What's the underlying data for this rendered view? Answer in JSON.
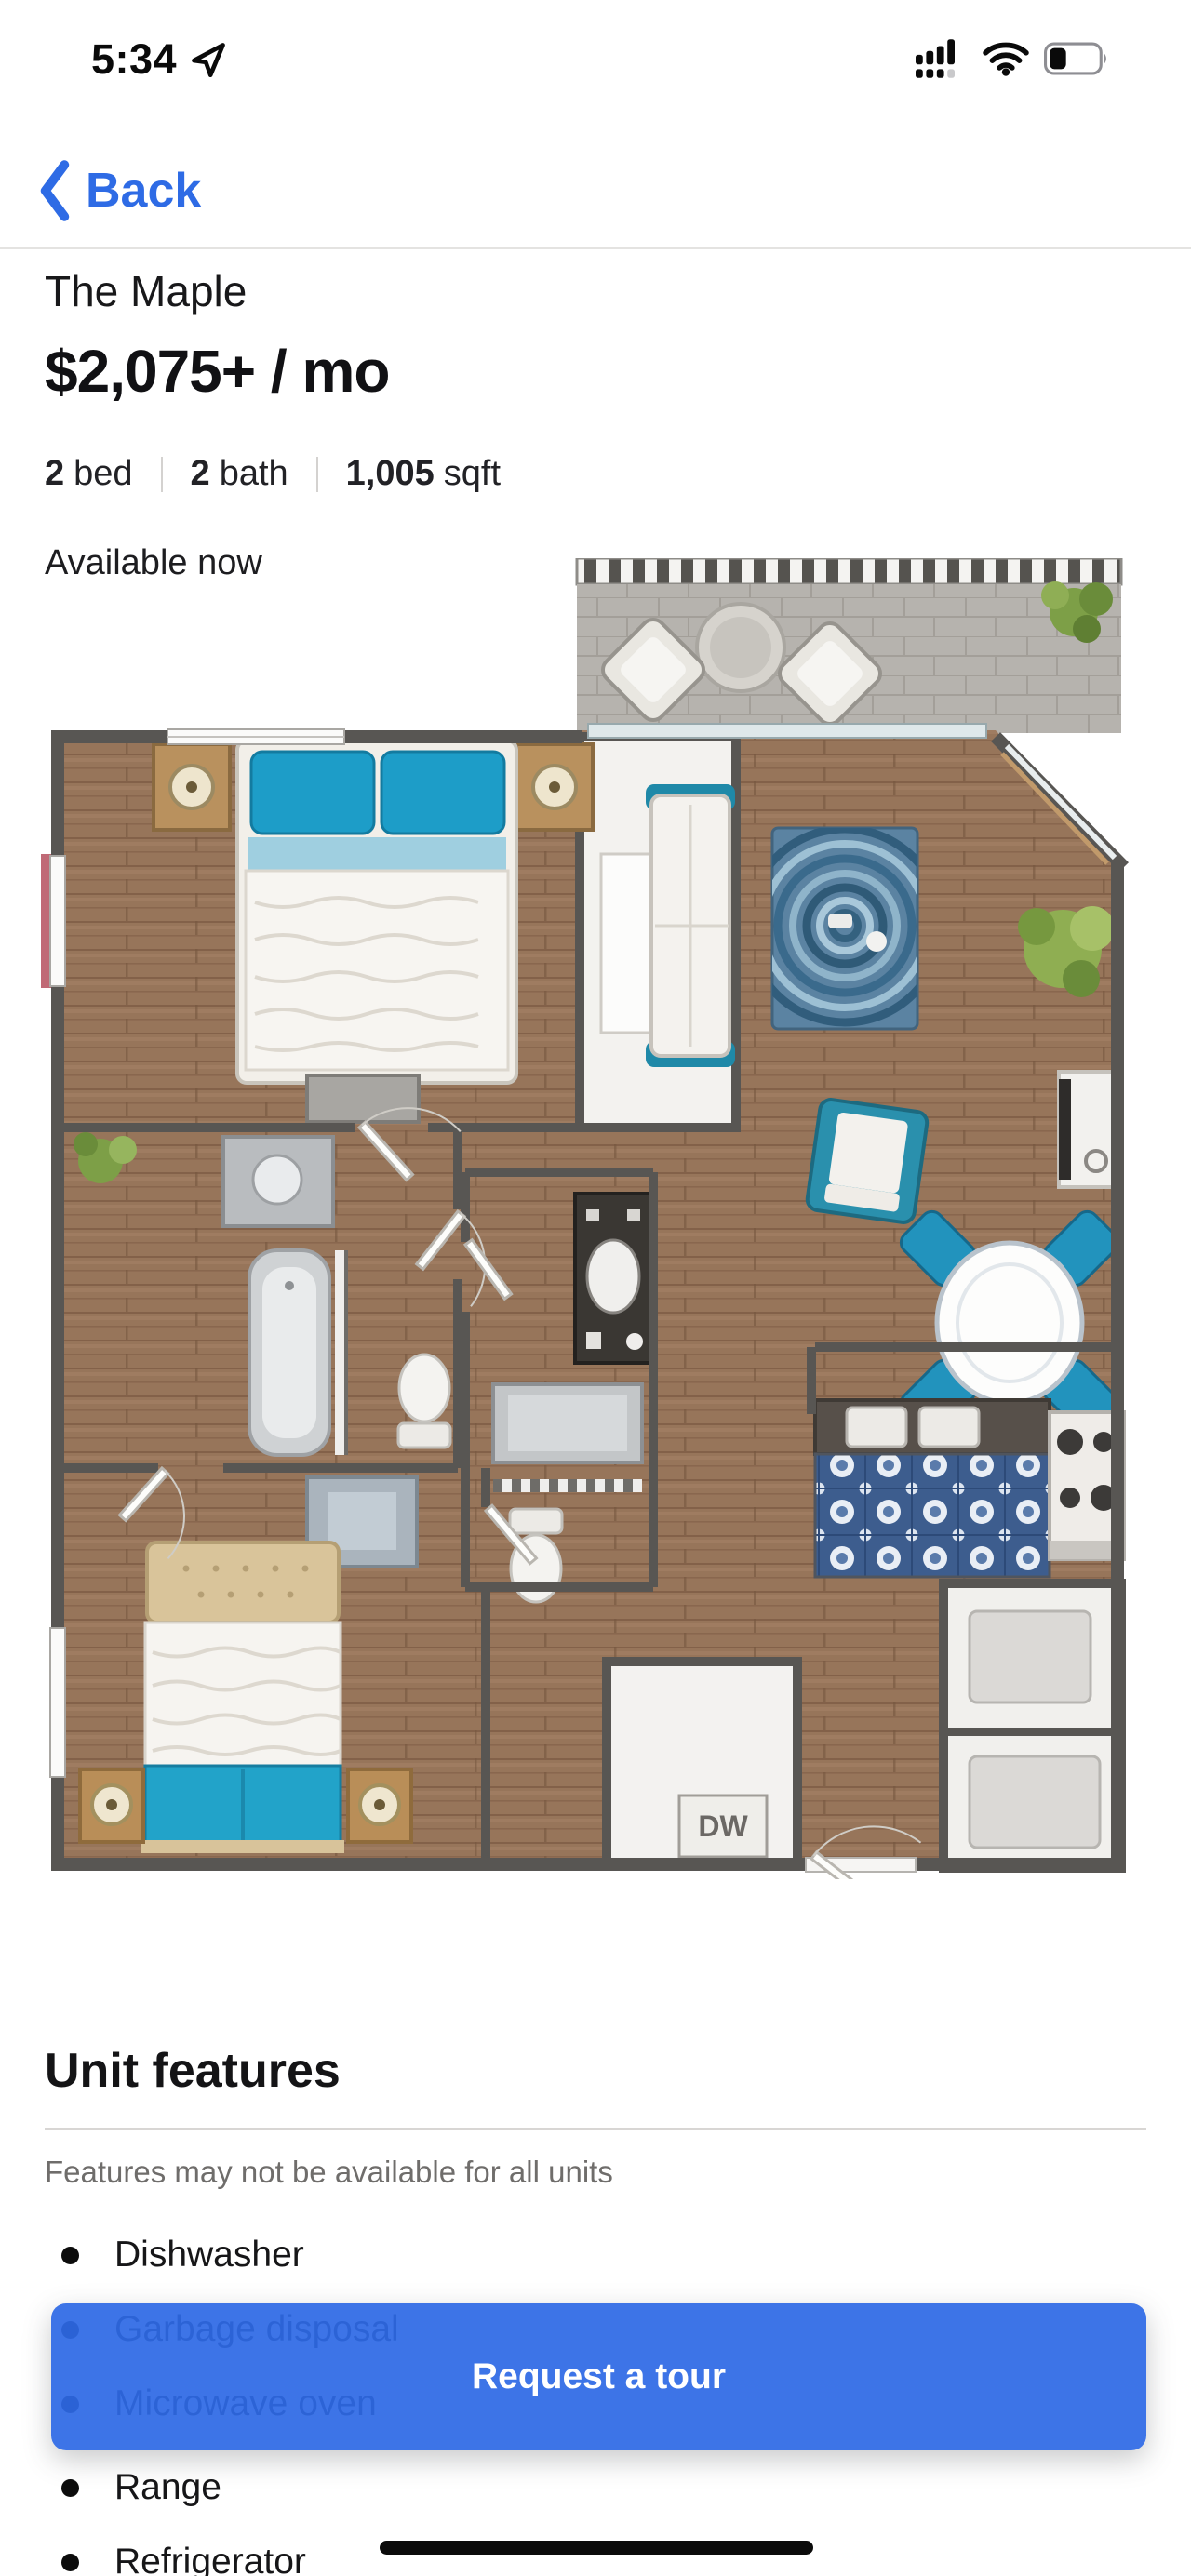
{
  "status_bar": {
    "time": "5:34",
    "icons": {
      "location": "location-arrow-icon",
      "cellular": "cellular-signal-dual-sim-icon",
      "wifi": "wifi-icon",
      "battery": "battery-low-icon"
    }
  },
  "nav": {
    "back_label": "Back"
  },
  "listing": {
    "name": "The Maple",
    "price": "$2,075+ / mo",
    "specs": [
      {
        "value": "2",
        "label": "bed"
      },
      {
        "value": "2",
        "label": "bath"
      },
      {
        "value": "1,005",
        "label": "sqft"
      }
    ],
    "availability": "Available now"
  },
  "floor_plan": {
    "dw_label": "DW"
  },
  "features": {
    "title": "Unit features",
    "note": "Features may not be available for all units",
    "items": [
      "Dishwasher",
      "Garbage disposal",
      "Microwave oven",
      "Range",
      "Refrigerator"
    ]
  },
  "cta": {
    "label": "Request a tour"
  },
  "colors": {
    "accent": "#2e6be5",
    "cta_background": "rgba(46,105,229,0.93)",
    "divider": "#d8d6d4",
    "muted_text": "#6f6d6b"
  }
}
